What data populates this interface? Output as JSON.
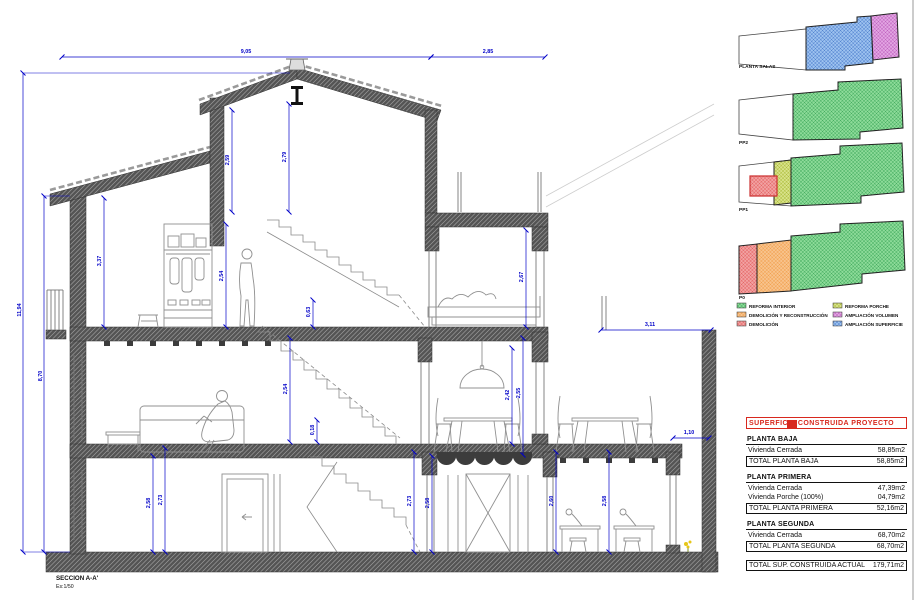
{
  "sheet": {
    "section_label": "SECCION A-A'",
    "scale_label": "Es:1/50"
  },
  "colors": {
    "dimension_blue": "#0000c8",
    "table_red": "#d8281e",
    "reforma_interior_green": "#8edc9a",
    "demolicion_reconstruccion_orange": "#f8c48e",
    "demolicion_red": "#f2a3a3",
    "reforma_porche_olive": "#d9e38b",
    "ampliacion_volumen_purple": "#e3a6e3",
    "ampliacion_superficie_blue": "#9ec3f0"
  },
  "dims": {
    "top_left": "9,05",
    "top_right": "2,85",
    "left_outer": "11,94",
    "left_inner": "8,70",
    "p2_left": "3,37",
    "p2_mid1": "2,59",
    "p2_mid2": "2,79",
    "p2_room": "2,54",
    "p2_small": "0,63",
    "p2_bed": "2,67",
    "p1_room": "2,54",
    "p1_small": "0,18",
    "p1_dining_a": "2,42",
    "p1_dining_b": "2,55",
    "p0_left_a": "2,58",
    "p0_left_b": "2,73",
    "p0_mid_a": "2,73",
    "p0_mid_b": "2,58",
    "p0_right_a": "2,60",
    "p0_right_b": "2,58",
    "terrace": "3,11",
    "patio": "1,10"
  },
  "plans": [
    {
      "label": "PLANTA SALAS"
    },
    {
      "label": "PP2"
    },
    {
      "label": "PP1"
    },
    {
      "label": "P0"
    }
  ],
  "legend": {
    "items": [
      {
        "label": "REFORMA INTERIOR",
        "color": "green"
      },
      {
        "label": "DEMOLICIÓN Y RECONSTRUCCIÓN",
        "color": "orange"
      },
      {
        "label": "DEMOLICIÓN",
        "color": "red"
      },
      {
        "label": "REFORMA PORCHE",
        "color": "olive"
      },
      {
        "label": "AMPLIACIÓN VOLUMEN",
        "color": "purple"
      },
      {
        "label": "AMPLIACIÓN SUPERFICIE",
        "color": "blue"
      }
    ]
  },
  "table": {
    "title": "SUPERFICIE CONSTRUIDA PROYECTO",
    "sections": [
      {
        "header": "PLANTA BAJA",
        "rows": [
          {
            "label": "Vivienda Cerrada",
            "value": "58,85m2"
          }
        ],
        "total": {
          "label": "TOTAL PLANTA BAJA",
          "value": "58,85m2"
        }
      },
      {
        "header": "PLANTA PRIMERA",
        "rows": [
          {
            "label": "Vivienda Cerrada",
            "value": "47,39m2"
          },
          {
            "label": "Vivienda Porche (100%)",
            "value": "04,79m2"
          }
        ],
        "total": {
          "label": "TOTAL PLANTA PRIMERA",
          "value": "52,16m2"
        }
      },
      {
        "header": "PLANTA SEGUNDA",
        "rows": [
          {
            "label": "Vivienda Cerrada",
            "value": "68,70m2"
          }
        ],
        "total": {
          "label": "TOTAL PLANTA SEGUNDA",
          "value": "68,70m2"
        }
      }
    ],
    "grand_total": {
      "label": "TOTAL SUP. CONSTRUIDA ACTUAL",
      "value": "179,71m2"
    }
  }
}
